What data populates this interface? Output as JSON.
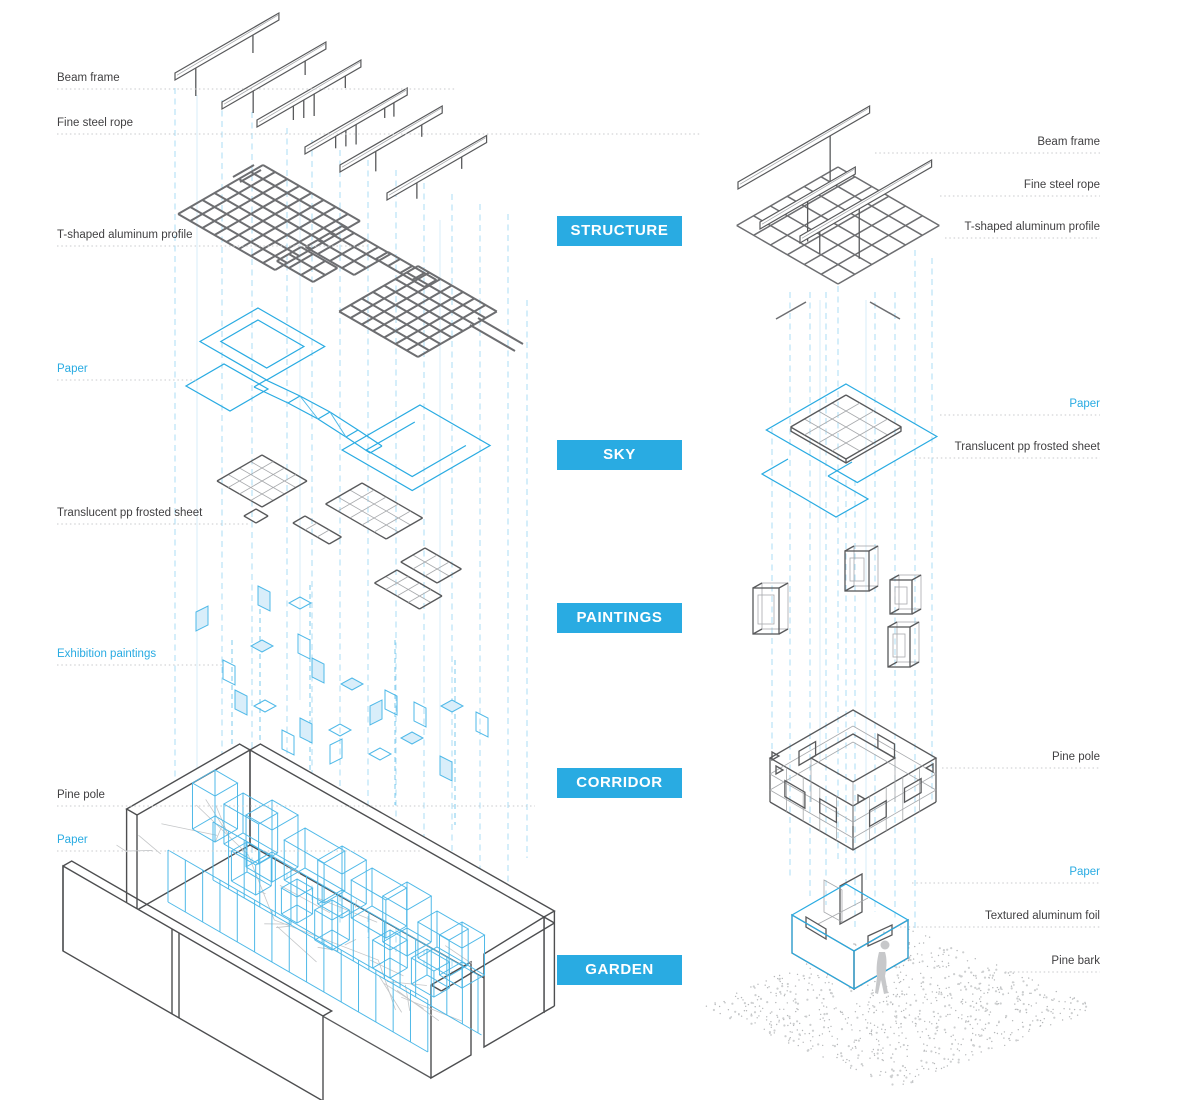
{
  "diagram": {
    "kind": "exploded-axonometric-architecture-diagram",
    "accent_color": "#29ABE2",
    "line_color": "#58595B",
    "background": "#FFFFFF"
  },
  "section_tags": [
    {
      "label": "STRUCTURE",
      "x": 557,
      "y": 216
    },
    {
      "label": "SKY",
      "x": 557,
      "y": 440
    },
    {
      "label": "PAINTINGS",
      "x": 557,
      "y": 603
    },
    {
      "label": "CORRIDOR",
      "x": 557,
      "y": 768
    },
    {
      "label": "GARDEN",
      "x": 557,
      "y": 955
    }
  ],
  "left_view": {
    "labels": [
      {
        "text": "Beam frame",
        "tone": "dark",
        "y": 82,
        "leader_to": 455
      },
      {
        "text": "Fine steel rope",
        "tone": "dark",
        "y": 127,
        "leader_to": 700
      },
      {
        "text": "T-shaped aluminum profile",
        "tone": "dark",
        "y": 239,
        "leader_to": 370
      },
      {
        "text": "Paper",
        "tone": "blue",
        "y": 373,
        "leader_to": 196
      },
      {
        "text": "Translucent pp frosted sheet",
        "tone": "dark",
        "y": 517,
        "leader_to": 250
      },
      {
        "text": "Exhibition paintings",
        "tone": "blue",
        "y": 658,
        "leader_to": 222
      },
      {
        "text": "Pine pole",
        "tone": "dark",
        "y": 799,
        "leader_to": 535
      },
      {
        "text": "Paper",
        "tone": "blue",
        "y": 844,
        "leader_to": 420
      }
    ]
  },
  "right_view": {
    "labels": [
      {
        "text": "Beam frame",
        "tone": "dark",
        "y": 146,
        "leader_from": 875
      },
      {
        "text": "Fine steel rope",
        "tone": "dark",
        "y": 189,
        "leader_from": 940
      },
      {
        "text": "T-shaped aluminum profile",
        "tone": "dark",
        "y": 231,
        "leader_from": 945
      },
      {
        "text": "Paper",
        "tone": "blue",
        "y": 408,
        "leader_from": 940
      },
      {
        "text": "Translucent pp frosted sheet",
        "tone": "dark",
        "y": 451,
        "leader_from": 915
      },
      {
        "text": "Pine pole",
        "tone": "dark",
        "y": 761,
        "leader_from": 942
      },
      {
        "text": "Paper",
        "tone": "blue",
        "y": 876,
        "leader_from": 912
      },
      {
        "text": "Textured aluminum foil",
        "tone": "dark",
        "y": 920,
        "leader_from": 900
      },
      {
        "text": "Pine bark",
        "tone": "dark",
        "y": 965,
        "leader_from": 1005
      }
    ]
  }
}
